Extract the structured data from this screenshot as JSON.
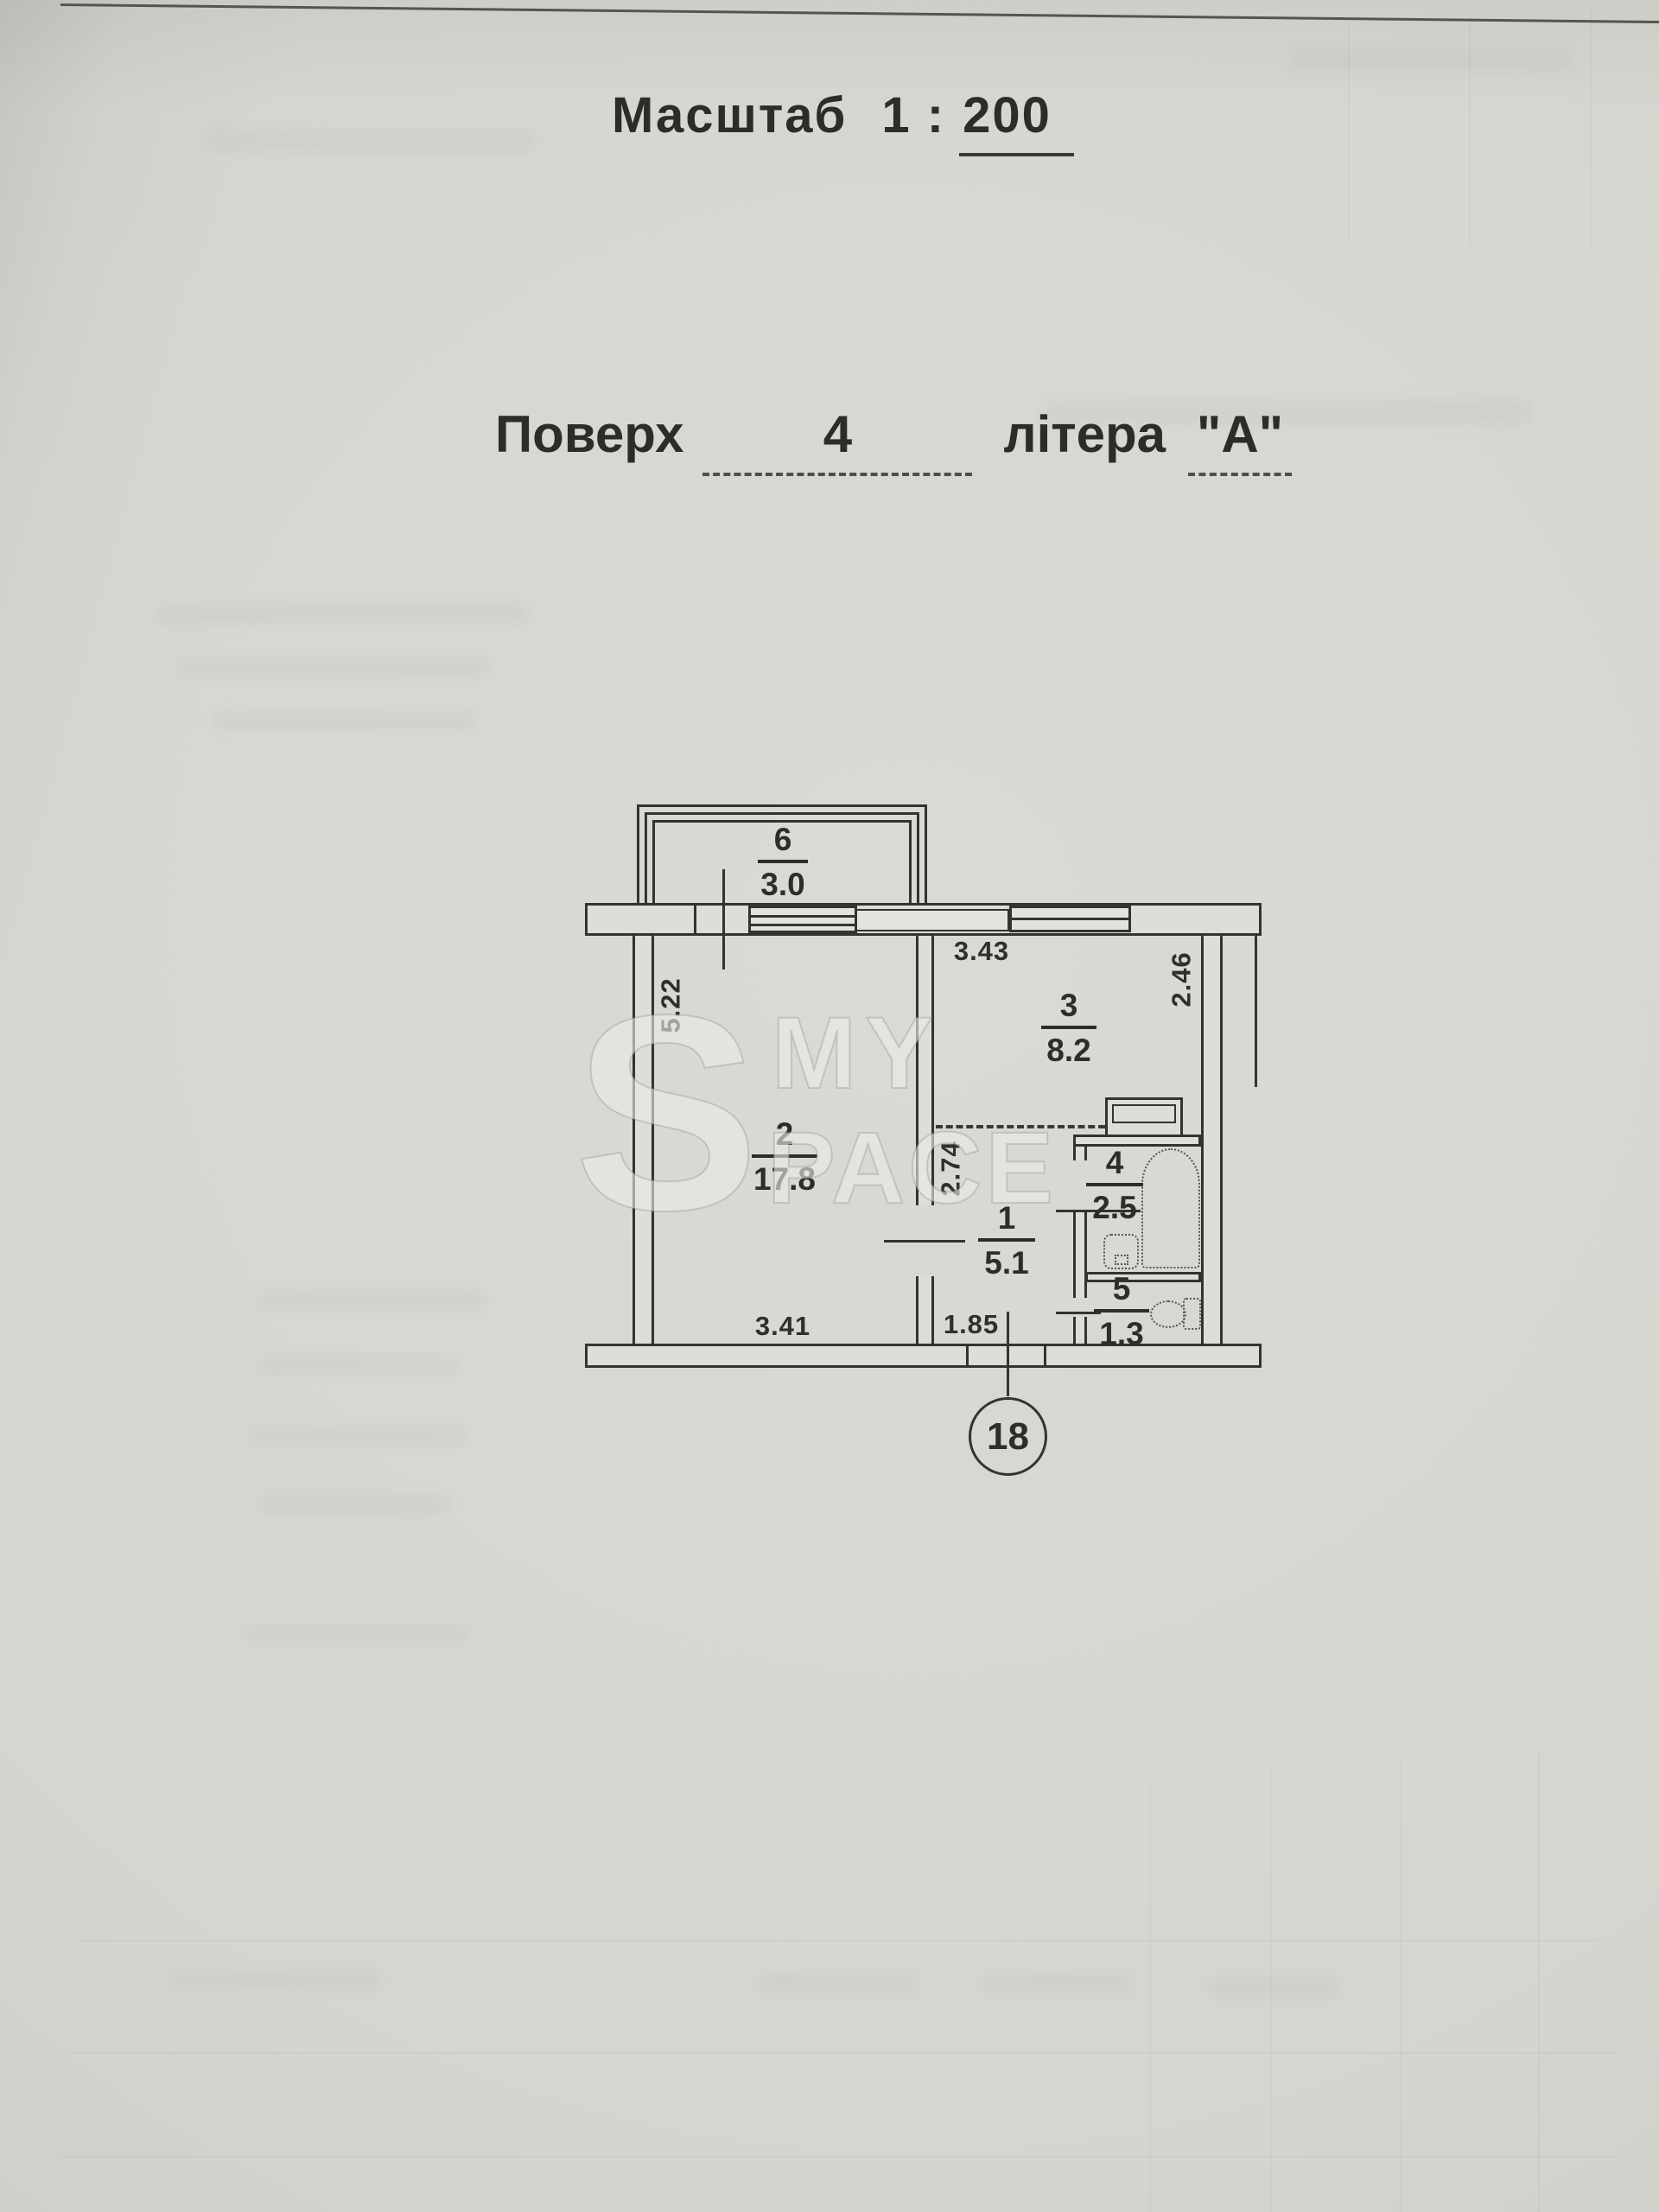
{
  "header": {
    "scale_label": "Масштаб",
    "scale_ratio_prefix": "1 :",
    "scale_ratio_value": "200",
    "floor_label": "Поверх",
    "floor_value": "4",
    "letter_label": "літера",
    "letter_value": "\"А\""
  },
  "plan": {
    "apartment_circle_number": "18",
    "rooms": [
      {
        "number": "6",
        "area": "3.0"
      },
      {
        "number": "3",
        "area": "8.2"
      },
      {
        "number": "2",
        "area": "17.8"
      },
      {
        "number": "1",
        "area": "5.1"
      },
      {
        "number": "4",
        "area": "2.5"
      },
      {
        "number": "5",
        "area": "1.3"
      }
    ],
    "dimensions": {
      "left_wall": "5.22",
      "kitchen_top": "3.43",
      "kitchen_right": "2.46",
      "hall_left": "2.74",
      "room_bottom": "3.41",
      "hall_bottom": "1.85"
    }
  },
  "watermark": {
    "letter": "S",
    "line1": "MY",
    "line2": "PACE"
  },
  "colors": {
    "paper": "#d6d5d0",
    "ink": "#34332e",
    "wall_fill": "#deddd8",
    "watermark": "#e9e8e3"
  }
}
